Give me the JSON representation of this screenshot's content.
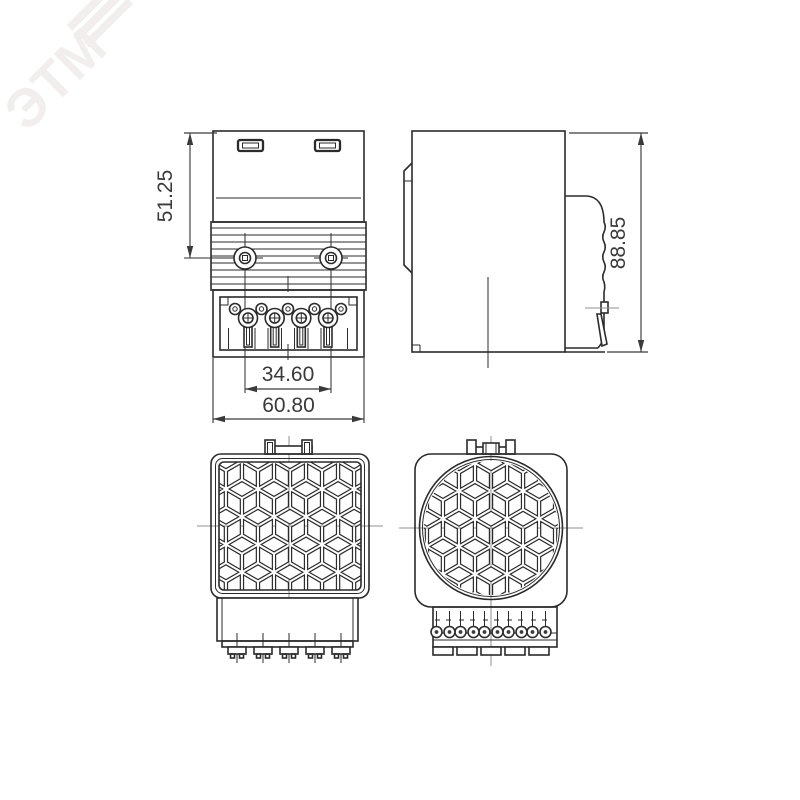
{
  "watermark": {
    "text": "ЭТМ"
  },
  "dimensions": {
    "upper_height": "51.25",
    "terminal_pitch": "34.60",
    "overall_width": "60.80",
    "overall_height": "88.85"
  },
  "colors": {
    "background": "#ffffff",
    "line": "#2b2b2b",
    "dimension": "#3a3a3a",
    "centerline": "#8f8f8f",
    "watermark": "#f2eeee"
  }
}
